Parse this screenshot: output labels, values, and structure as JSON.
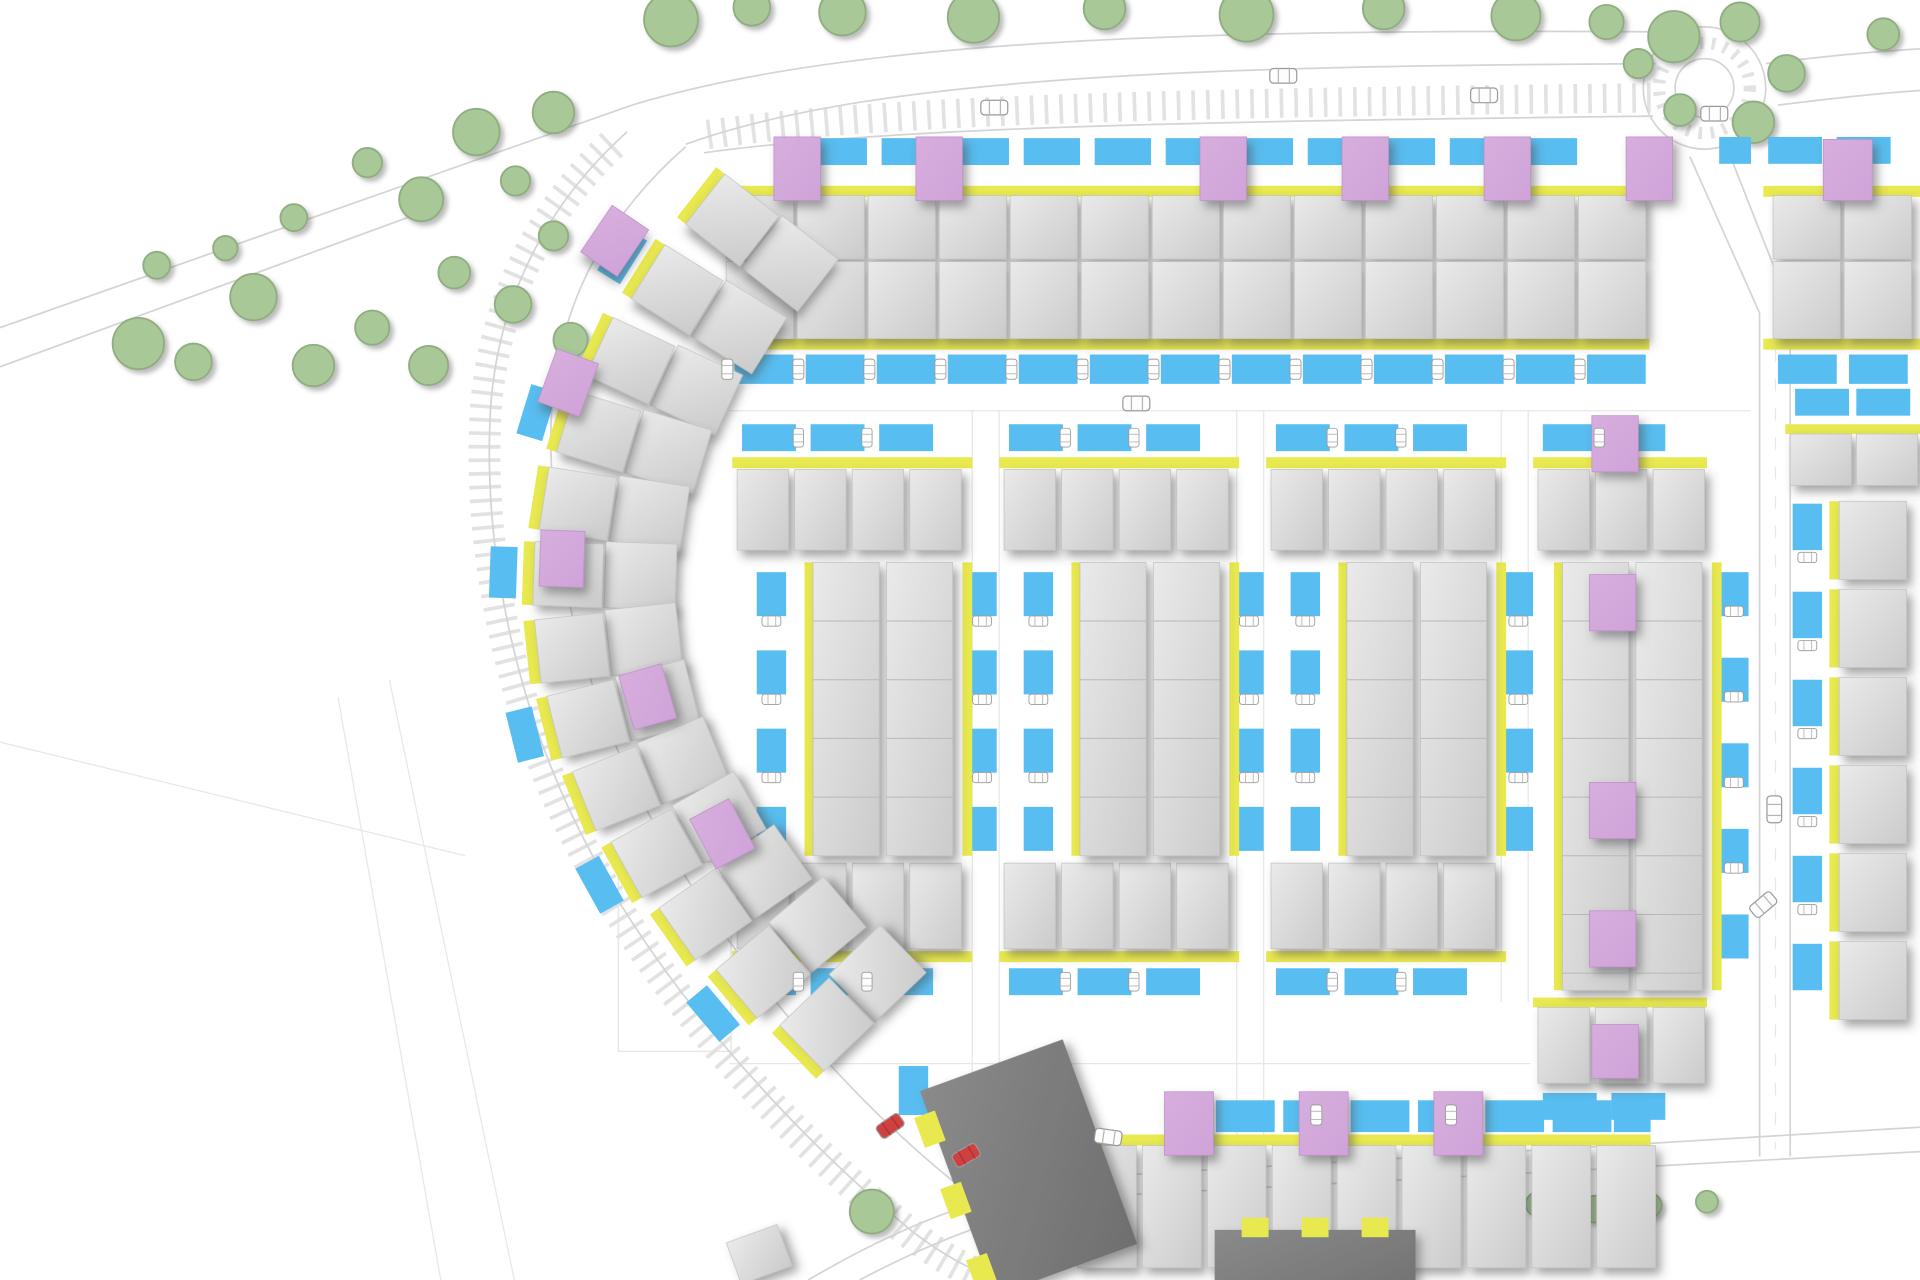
{
  "meta": {
    "kind": "architectural-site-plan",
    "visible_text": ""
  },
  "palette": {
    "background": "#ffffff",
    "road_line": "#d4d4d4",
    "faint_line": "#e7e7e7",
    "ladder": "#e2e2e2",
    "tree_fill": "#a8c897",
    "tree_stroke": "#90ad81",
    "house_light": "#eaeaea",
    "house_dark": "#cbcbcb",
    "house_stroke": "#c2c2c2",
    "entrance_yellow": "#e8e94f",
    "parking_blue": "#58bdf0",
    "accent_pink": "#cfa3d8",
    "apartment_light": "#8a8a8a",
    "apartment_dark": "#6f6f6f",
    "car_body": "#fdfdfd",
    "car_stroke": "#9a9a9a",
    "car_red": "#d04040",
    "division_line": "#b8b8b8"
  },
  "canvas": {
    "w": 1568,
    "h": 1047
  },
  "roads": {
    "lines": [
      "M0,268 L516,86",
      "M0,300 L360,168",
      "M516,86 C700,30 1000,24 1352,26",
      "M560,118 C720,60 1010,54 1352,52",
      "M575,125 C730,103 1010,99 1350,95",
      "M560,120 C480,190 452,272 450,348 C448,452 474,562 530,666 C586,770 676,880 766,956 C800,984 826,1006 848,1028",
      "M512,108 C432,180 402,268 400,348 C396,460 424,590 484,700 C544,812 646,926 746,1008 C772,1028 796,1040 816,1047",
      "M1380,128 L1437,256",
      "M1410,120 L1462,252",
      "M1437,256 L1437,946",
      "M1462,252 L1462,946",
      "M660,1047 C740,1000 812,972 902,962 L1568,922",
      "M702,1047 C772,1010 838,986 908,978 L1568,942",
      "M1442,52 C1490,46 1532,42 1568,40",
      "M1452,86 C1500,80 1540,76 1568,74"
    ],
    "ladders": [
      {
        "d": "M500,118 C428,186 398,272 396,350 C392,462 420,592 480,702 C540,814 642,928 742,1008 C766,1027 790,1040 810,1047",
        "w": 26,
        "dash": "3 8"
      },
      {
        "d": "M578,110 C732,88 1010,84 1348,80",
        "w": 24,
        "dash": "3 9"
      }
    ],
    "faint": [
      "M318,556 L420,1047",
      "M276,570 L360,1047",
      "M0,607 L380,700",
      "M794,336 L794,928",
      "M816,336 L816,928",
      "M1010,336 L1010,928",
      "M1032,336 L1032,928",
      "M1226,336 L1226,820",
      "M1248,336 L1248,820",
      "M596,336 L1430,336",
      "M596,870 L1250,870"
    ],
    "plots": [
      [
        505,
        705,
        92,
        155
      ]
    ],
    "roundabout": {
      "cx": 1392,
      "cy": 72,
      "r_outer": 50,
      "r_inner": 24,
      "r_dash": 37
    },
    "dashed_center": "M1450,262 L1450,940"
  },
  "trees": [
    [
      113,
      281,
      21
    ],
    [
      158,
      296,
      15
    ],
    [
      207,
      243,
      19
    ],
    [
      256,
      299,
      17
    ],
    [
      304,
      268,
      14
    ],
    [
      350,
      299,
      16
    ],
    [
      300,
      133,
      12
    ],
    [
      344,
      163,
      18
    ],
    [
      389,
      108,
      19
    ],
    [
      421,
      148,
      12
    ],
    [
      452,
      92,
      17
    ],
    [
      371,
      223,
      13
    ],
    [
      419,
      249,
      15
    ],
    [
      452,
      193,
      12
    ],
    [
      466,
      278,
      14
    ],
    [
      128,
      217,
      11
    ],
    [
      184,
      203,
      10
    ],
    [
      240,
      178,
      11
    ],
    [
      548,
      16,
      22
    ],
    [
      614,
      6,
      15
    ],
    [
      688,
      10,
      19
    ],
    [
      795,
      14,
      21
    ],
    [
      902,
      7,
      17
    ],
    [
      1018,
      12,
      22
    ],
    [
      1130,
      7,
      17
    ],
    [
      1238,
      13,
      20
    ],
    [
      1312,
      18,
      14
    ],
    [
      1367,
      30,
      21
    ],
    [
      1421,
      18,
      16
    ],
    [
      1459,
      60,
      15
    ],
    [
      1432,
      100,
      17
    ],
    [
      1372,
      90,
      13
    ],
    [
      1338,
      52,
      12
    ],
    [
      1538,
      28,
      13
    ],
    [
      712,
      991,
      18
    ],
    [
      820,
      926,
      13
    ],
    [
      1215,
      986,
      12
    ],
    [
      1256,
      985,
      10
    ],
    [
      1303,
      989,
      11
    ],
    [
      1347,
      986,
      10
    ],
    [
      1394,
      983,
      9
    ]
  ],
  "house_rows": [
    [
      593,
      160,
      55,
      52,
      13,
      58,
      0
    ],
    [
      1448,
      160,
      55,
      52,
      2,
      58,
      0
    ],
    [
      593,
      214,
      55,
      63,
      13,
      58,
      0
    ],
    [
      1448,
      214,
      55,
      63,
      2,
      58,
      0
    ],
    [
      602,
      384,
      42,
      66,
      4,
      47,
      0
    ],
    [
      820,
      384,
      42,
      66,
      4,
      47,
      0
    ],
    [
      1038,
      384,
      42,
      66,
      4,
      47,
      0
    ],
    [
      1256,
      384,
      42,
      66,
      3,
      47,
      0
    ],
    [
      1462,
      355,
      50,
      42,
      2,
      54,
      0
    ],
    [
      602,
      706,
      42,
      70,
      4,
      47,
      0
    ],
    [
      820,
      706,
      42,
      70,
      4,
      47,
      0
    ],
    [
      1038,
      706,
      42,
      70,
      4,
      47,
      0
    ],
    [
      1256,
      824,
      42,
      62,
      3,
      47,
      0
    ],
    [
      880,
      937,
      48,
      100,
      9,
      53,
      0
    ],
    [
      1502,
      410,
      55,
      64,
      6,
      0,
      72
    ]
  ],
  "terraces": [
    [
      664,
      460,
      54,
      240
    ],
    [
      724,
      460,
      54,
      240
    ],
    [
      882,
      460,
      54,
      240
    ],
    [
      942,
      460,
      54,
      240
    ],
    [
      1100,
      460,
      54,
      240
    ],
    [
      1160,
      460,
      54,
      240
    ],
    [
      1276,
      460,
      54,
      350
    ],
    [
      1336,
      460,
      54,
      350
    ]
  ],
  "yellows": [
    [
      590,
      152,
      757,
      9
    ],
    [
      1440,
      152,
      128,
      9
    ],
    [
      590,
      277,
      757,
      9
    ],
    [
      1440,
      277,
      128,
      9
    ],
    [
      598,
      374,
      196,
      9
    ],
    [
      816,
      374,
      196,
      9
    ],
    [
      1034,
      374,
      196,
      9
    ],
    [
      1252,
      374,
      142,
      9
    ],
    [
      1458,
      347,
      112,
      8
    ],
    [
      598,
      778,
      196,
      9
    ],
    [
      816,
      778,
      196,
      9
    ],
    [
      1034,
      778,
      196,
      9
    ],
    [
      1252,
      816,
      142,
      8
    ],
    [
      876,
      928,
      472,
      9
    ],
    [
      657,
      460,
      8,
      240
    ],
    [
      786,
      460,
      8,
      240
    ],
    [
      875,
      460,
      8,
      240
    ],
    [
      1004,
      460,
      8,
      240
    ],
    [
      1093,
      460,
      8,
      240
    ],
    [
      1222,
      460,
      8,
      240
    ],
    [
      1269,
      460,
      8,
      350
    ],
    [
      1398,
      460,
      8,
      350
    ]
  ],
  "yellow_rows": [
    [
      1494,
      410,
      8,
      64,
      6,
      0,
      72
    ]
  ],
  "blue_rows": [
    [
      662,
      113,
      46,
      22,
      11,
      58,
      0
    ],
    [
      1404,
      112,
      26,
      22,
      1,
      0,
      0
    ],
    [
      1444,
      112,
      44,
      22,
      1,
      0,
      0
    ],
    [
      1500,
      112,
      44,
      22,
      1,
      0,
      0
    ],
    [
      600,
      290,
      48,
      24,
      13,
      58,
      0
    ],
    [
      1452,
      290,
      48,
      24,
      2,
      58,
      0
    ],
    [
      606,
      347,
      44,
      22,
      3,
      56,
      0
    ],
    [
      824,
      347,
      44,
      22,
      3,
      56,
      0
    ],
    [
      1042,
      347,
      44,
      22,
      3,
      56,
      0
    ],
    [
      1260,
      347,
      44,
      22,
      2,
      56,
      0
    ],
    [
      1466,
      318,
      44,
      22,
      1,
      0,
      0
    ],
    [
      1516,
      318,
      44,
      22,
      1,
      0,
      0
    ],
    [
      618,
      468,
      24,
      36,
      4,
      0,
      64
    ],
    [
      790,
      468,
      24,
      36,
      4,
      0,
      64
    ],
    [
      836,
      468,
      24,
      36,
      4,
      0,
      64
    ],
    [
      1008,
      468,
      24,
      36,
      4,
      0,
      64
    ],
    [
      1054,
      468,
      24,
      36,
      4,
      0,
      64
    ],
    [
      1228,
      468,
      24,
      36,
      4,
      0,
      64
    ],
    [
      1404,
      468,
      24,
      36,
      5,
      0,
      70
    ],
    [
      1464,
      412,
      24,
      38,
      6,
      0,
      72
    ],
    [
      606,
      792,
      44,
      22,
      3,
      56,
      0
    ],
    [
      824,
      792,
      44,
      22,
      3,
      56,
      0
    ],
    [
      1042,
      792,
      44,
      22,
      3,
      56,
      0
    ],
    [
      1260,
      894,
      44,
      22,
      2,
      56,
      0
    ],
    [
      993,
      900,
      48,
      26,
      2,
      55,
      0
    ],
    [
      1103,
      900,
      48,
      26,
      2,
      55,
      0
    ],
    [
      1213,
      900,
      48,
      26,
      2,
      55,
      0
    ],
    [
      1318,
      900,
      30,
      26,
      1,
      0,
      0
    ],
    [
      734,
      872,
      24,
      40,
      1,
      0,
      0
    ]
  ],
  "pinks": [
    [
      632,
      112,
      38,
      52
    ],
    [
      748,
      112,
      38,
      52
    ],
    [
      980,
      112,
      38,
      52
    ],
    [
      1096,
      112,
      38,
      52
    ],
    [
      1212,
      112,
      38,
      52
    ],
    [
      1328,
      112,
      38,
      52
    ],
    [
      1489,
      114,
      40,
      50
    ],
    [
      1300,
      340,
      38,
      46
    ],
    [
      1298,
      470,
      38,
      46
    ],
    [
      1298,
      640,
      38,
      46
    ],
    [
      1298,
      745,
      38,
      46
    ],
    [
      1300,
      838,
      38,
      44
    ],
    [
      951,
      893,
      40,
      52
    ],
    [
      1061,
      893,
      40,
      52
    ],
    [
      1171,
      893,
      40,
      52
    ]
  ],
  "arc_houses": [
    [
      598,
      180,
      38,
      0
    ],
    [
      553,
      237,
      32,
      1
    ],
    [
      515,
      295,
      25,
      0
    ],
    [
      489,
      353,
      17,
      1
    ],
    [
      472,
      412,
      9,
      0
    ],
    [
      464,
      470,
      2,
      1
    ],
    [
      467,
      530,
      -6,
      0
    ],
    [
      480,
      588,
      -14,
      1
    ],
    [
      503,
      645,
      -22,
      0
    ],
    [
      536,
      698,
      -29,
      1
    ],
    [
      576,
      748,
      -35,
      0
    ],
    [
      623,
      795,
      -40,
      1
    ],
    [
      675,
      838,
      -44,
      0
    ]
  ],
  "arc_pinks": [
    [
      502,
      197,
      34
    ],
    [
      464,
      313,
      20
    ],
    [
      459,
      457,
      2
    ],
    [
      529,
      570,
      -16
    ],
    [
      590,
      682,
      -28
    ]
  ],
  "dark_blocks": [
    [
      840,
      955,
      124,
      178,
      -20,
      "left"
    ],
    [
      1074,
      1038,
      164,
      64,
      0,
      "top"
    ]
  ],
  "gray_singles": [
    [
      598,
      1008,
      44,
      36,
      -20
    ]
  ],
  "cars": [
    [
      812,
      88,
      0,
      0
    ],
    [
      1212,
      78,
      0,
      0
    ],
    [
      1400,
      93,
      0,
      0
    ],
    [
      1048,
      62,
      0,
      0
    ],
    [
      928,
      330,
      0,
      0
    ],
    [
      1449,
      662,
      90,
      0
    ],
    [
      1440,
      740,
      -40,
      0
    ],
    [
      905,
      930,
      8,
      0
    ],
    [
      727,
      921,
      -35,
      1
    ],
    [
      789,
      945,
      -30,
      1
    ]
  ],
  "car_rows": [
    [
      594,
      302,
      13,
      58,
      0,
      90,
      0.75
    ],
    [
      652,
      358,
      2,
      56,
      0,
      90,
      0.7
    ],
    [
      870,
      358,
      2,
      56,
      0,
      90,
      0.7
    ],
    [
      1088,
      358,
      2,
      56,
      0,
      90,
      0.7
    ],
    [
      1306,
      358,
      1,
      0,
      0,
      90,
      0.7
    ],
    [
      630,
      508,
      3,
      0,
      64,
      0,
      0.7
    ],
    [
      802,
      508,
      3,
      0,
      64,
      0,
      0.7
    ],
    [
      848,
      508,
      3,
      0,
      64,
      0,
      0.7
    ],
    [
      1020,
      508,
      3,
      0,
      64,
      0,
      0.7
    ],
    [
      1066,
      508,
      3,
      0,
      64,
      0,
      0.7
    ],
    [
      1240,
      508,
      3,
      0,
      64,
      0,
      0.7
    ],
    [
      1416,
      500,
      4,
      0,
      70,
      0,
      0.7
    ],
    [
      1476,
      456,
      5,
      0,
      72,
      0,
      0.7
    ],
    [
      652,
      803,
      2,
      56,
      0,
      90,
      0.7
    ],
    [
      870,
      803,
      2,
      56,
      0,
      90,
      0.7
    ],
    [
      1088,
      803,
      2,
      56,
      0,
      90,
      0.7
    ],
    [
      1075,
      912,
      2,
      110,
      0,
      90,
      0.75
    ]
  ]
}
